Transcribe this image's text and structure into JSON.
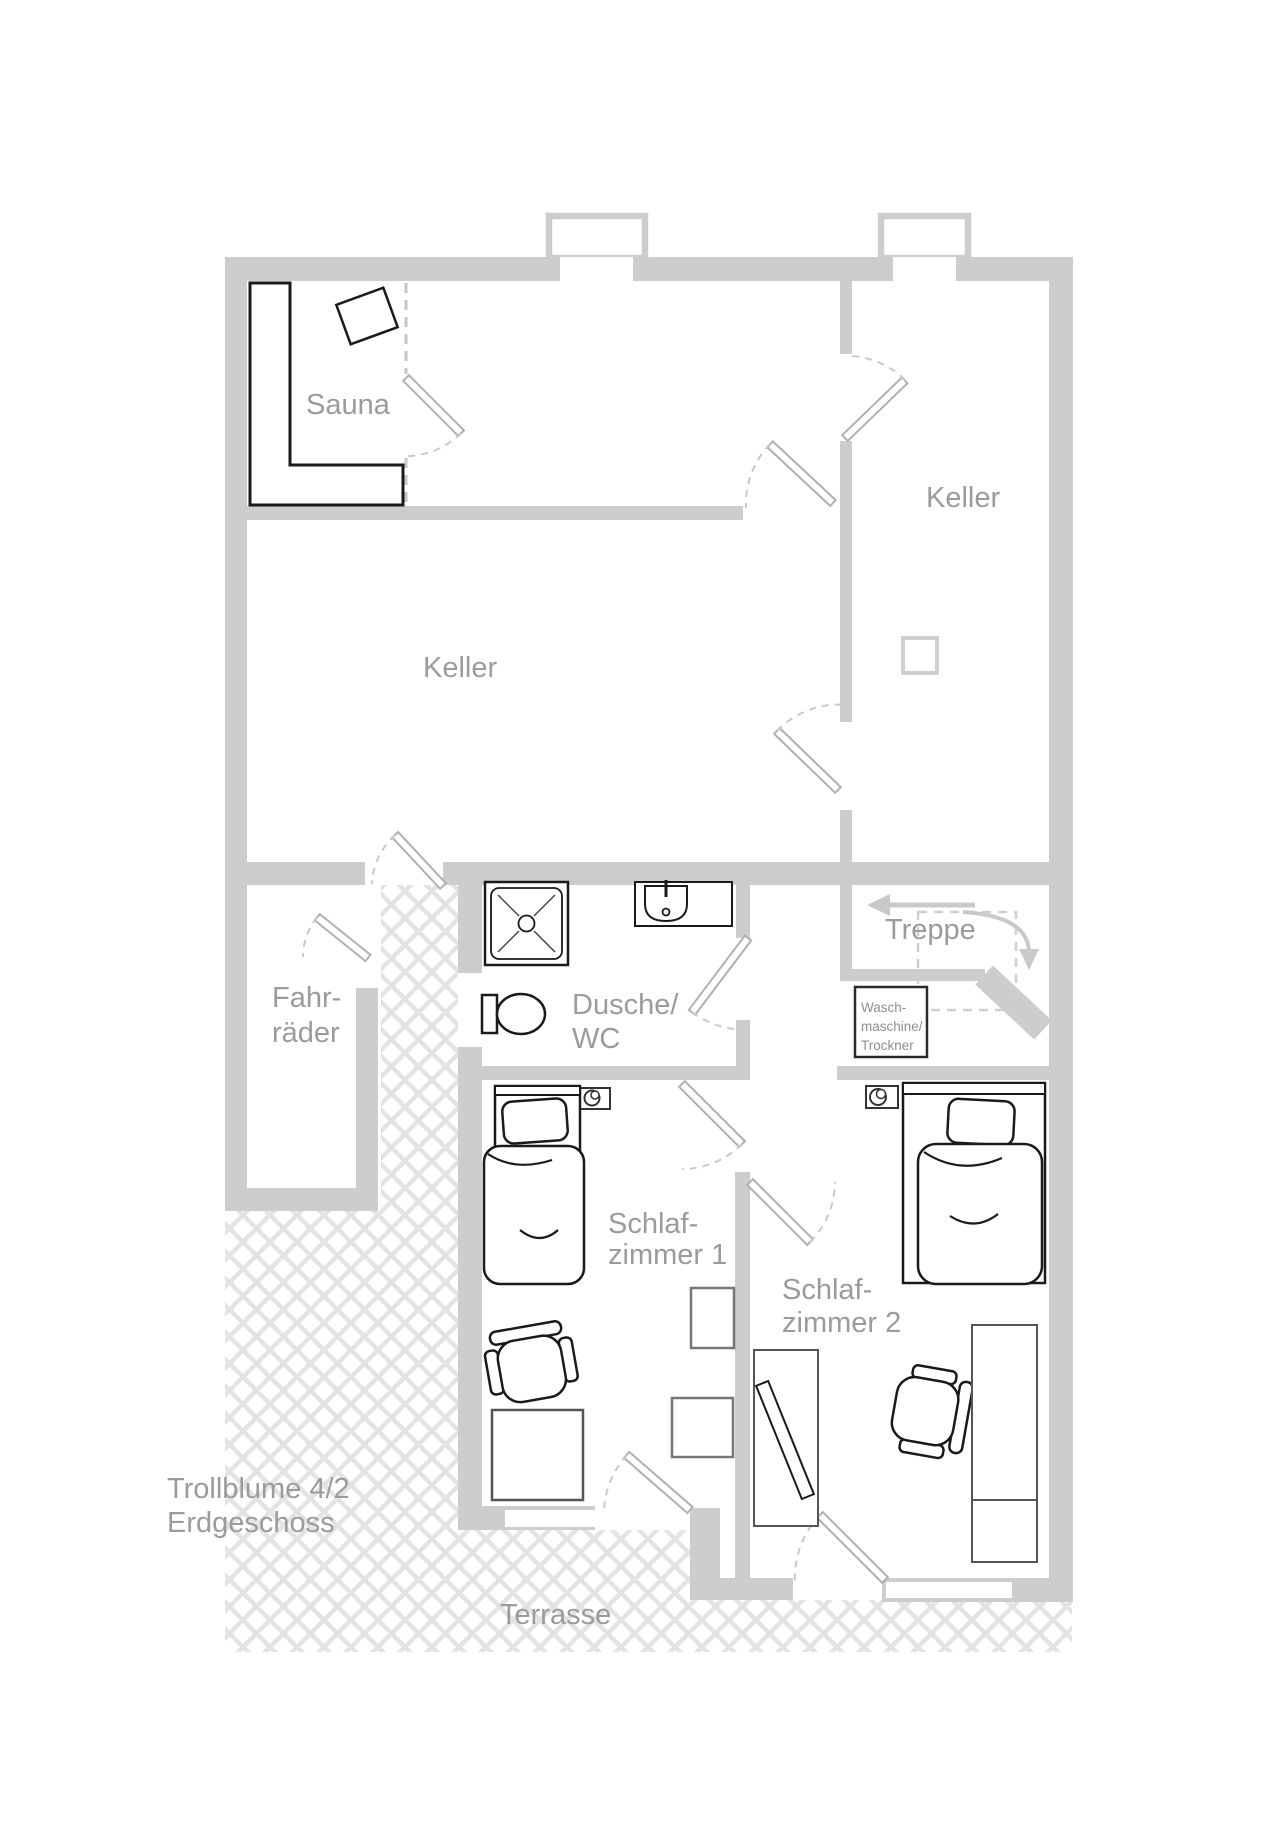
{
  "labels": {
    "sauna": "Sauna",
    "keller_top_right": "Keller",
    "keller_main": "Keller",
    "treppe": "Treppe",
    "fahrraeder_line1": "Fahr-",
    "fahrraeder_line2": "räder",
    "dusche_line1": "Dusche/",
    "dusche_line2": "WC",
    "waschmaschine_line1": "Wasch-",
    "waschmaschine_line2": "maschine/",
    "waschmaschine_line3": "Trockner",
    "schlafzimmer1_line1": "Schlaf-",
    "schlafzimmer1_line2": "zimmer 1",
    "schlafzimmer2_line1": "Schlaf-",
    "schlafzimmer2_line2": "zimmer 2",
    "terrasse": "Terrasse",
    "address_line1": "Trollblume 4/2",
    "address_line2": "Erdgeschoss"
  },
  "colors": {
    "wall": "#cdcdcd",
    "hatch_line": "#e3e3e3",
    "label_text": "#9b9b9b",
    "dark_outline": "#1a1a1a",
    "furniture_gray": "#6e6e6e",
    "door_stroke": "#b0b0b0",
    "stair_dash": "#cfcfcf",
    "background": "#ffffff"
  }
}
